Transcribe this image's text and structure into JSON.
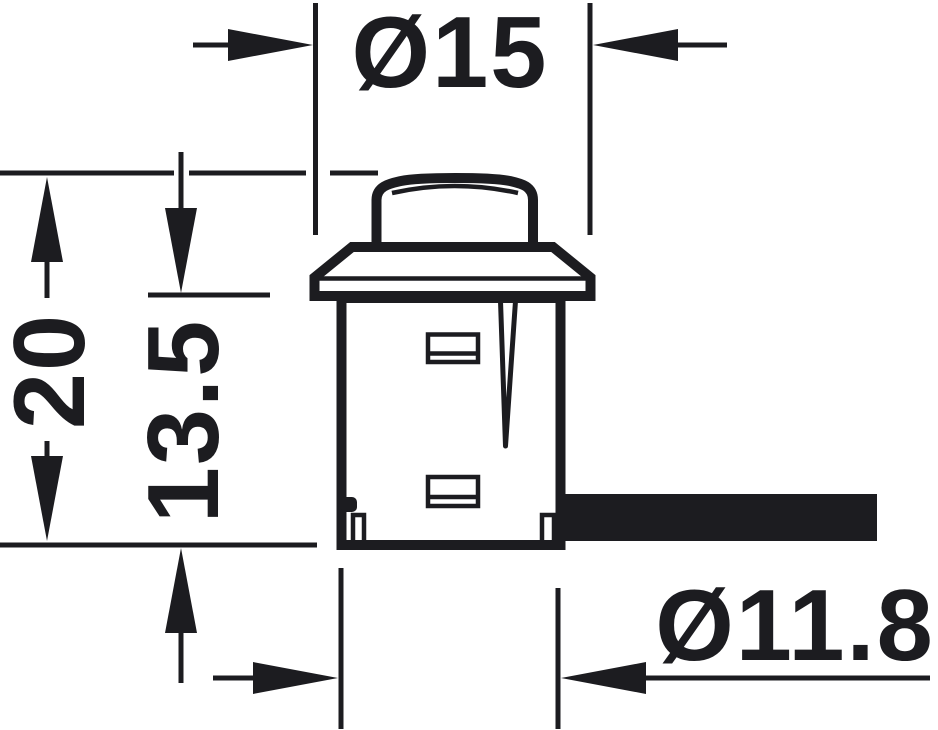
{
  "page": {
    "background": "#ffffff",
    "ink_color": "#1c1c20"
  },
  "drawing": {
    "type": "technical-dimension-drawing",
    "component": "push-button switch with round flange and cable, side elevation",
    "dimensions": {
      "head_diameter": "Ø15",
      "overall_height": "20",
      "body_height": "13.5",
      "body_diameter": "Ø11.8"
    }
  }
}
